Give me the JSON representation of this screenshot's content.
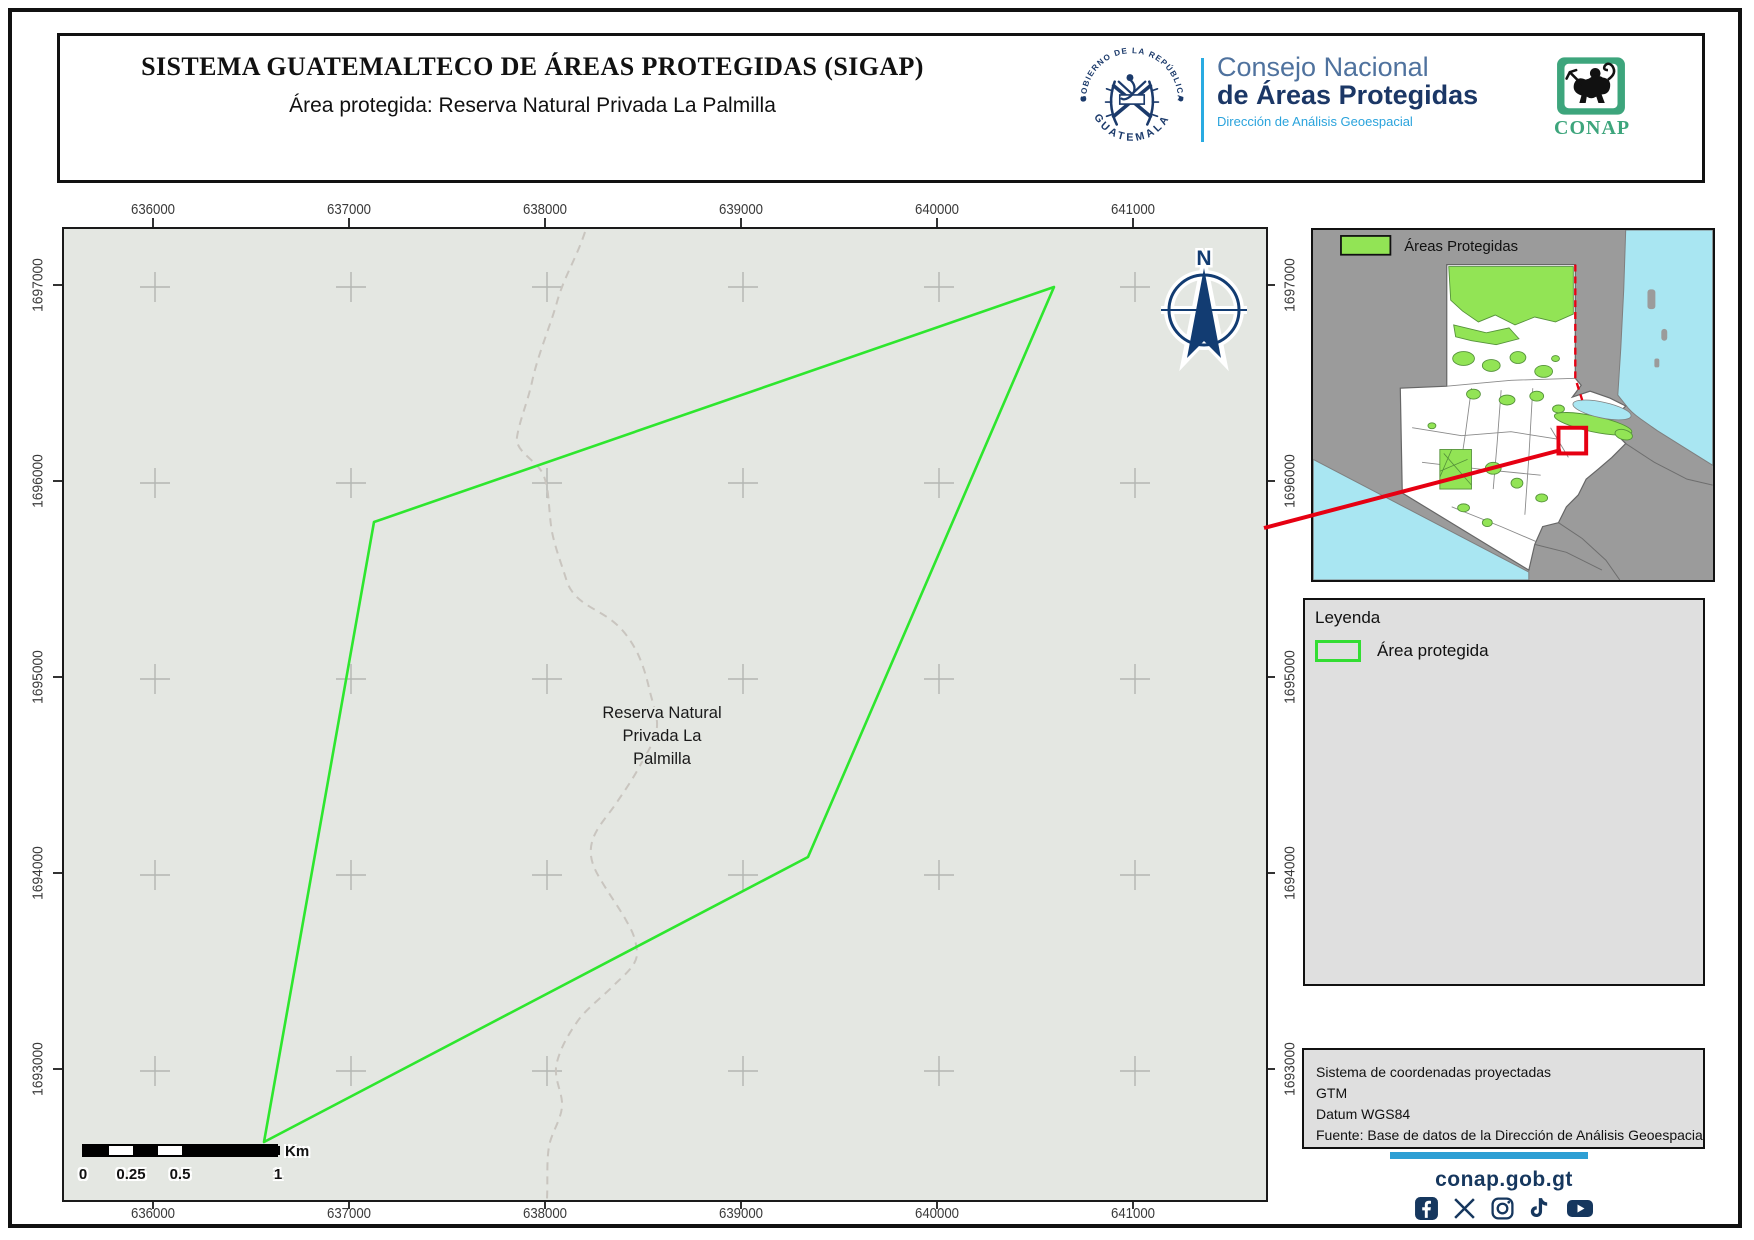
{
  "header": {
    "title": "SISTEMA GUATEMALTECO DE ÁREAS PROTEGIDAS  (SIGAP)",
    "subtitle": "Área protegida: Reserva Natural Privada La Palmilla"
  },
  "branding": {
    "emblem_text_top": "GOBIERNO DE LA REPÚBLICA",
    "emblem_text_bottom": "GUATEMALA",
    "council_line1": "Consejo Nacional",
    "council_line2": "de Áreas Protegidas",
    "council_line3": "Dirección de Análisis Geoespacial",
    "conap_label": "CONAP"
  },
  "map": {
    "x_ticks": [
      "636000",
      "637000",
      "638000",
      "639000",
      "640000",
      "641000"
    ],
    "y_ticks": [
      "1697000",
      "1696000",
      "1695000",
      "1694000",
      "1693000"
    ],
    "north_label": "N",
    "area_label": [
      "Reserva Natural",
      "Privada La",
      "Palmilla"
    ]
  },
  "inset": {
    "legend_label": "Áreas Protegidas"
  },
  "legend": {
    "title": "Leyenda",
    "items": [
      {
        "label": "Área protegida",
        "color": "#33dd33"
      }
    ]
  },
  "info_box": {
    "lines": [
      "Sistema de coordenadas proyectadas",
      "GTM",
      "Datum WGS84",
      "Fuente: Base de datos de la Dirección de Análisis Geoespacial"
    ]
  },
  "scale_bar": {
    "tick_labels": [
      "0",
      "0.25",
      "0.5",
      "1"
    ],
    "unit": "Km"
  },
  "footer": {
    "website": "conap.gob.gt",
    "social_icons": [
      "facebook-icon",
      "x-icon",
      "instagram-icon",
      "tiktok-icon",
      "youtube-icon"
    ]
  },
  "colors": {
    "protected_area_outline": "#2ee62e",
    "inset_protected_fill": "#92e455",
    "water": "#a9e6f2",
    "neighbor_land": "#9b9b9b",
    "navy": "#16375e",
    "accent_blue": "#2e9fd4",
    "red_locator": "#e60012",
    "map_background": "#e4e7e2"
  }
}
